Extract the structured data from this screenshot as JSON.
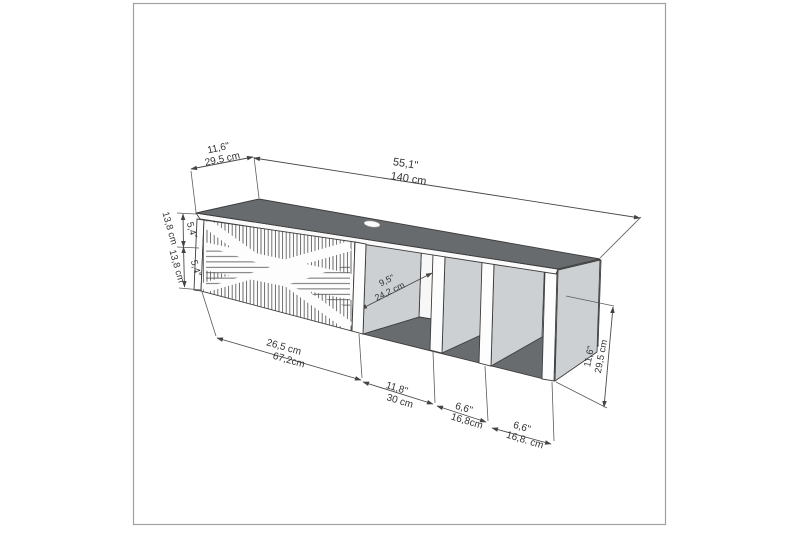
{
  "figure": {
    "kind": "technical dimension drawing",
    "subject": "wall-mounted TV stand with ribbed door and three open shelves"
  },
  "labels": {
    "top_depth_in": "11,6\"",
    "top_depth_cm": "29,5 cm",
    "top_width_in": "55,1\"",
    "top_width_cm": "140 cm",
    "left_upper_in": "5,4\"",
    "left_upper_cm": "13,8 cm",
    "left_lower_in": "5,4\"",
    "left_lower_cm": "13,8 cm",
    "inner_depth_in": "9,5\"",
    "inner_depth_cm": "24,2 cm",
    "bottom_door_a": "26,5 cm",
    "bottom_door_b": "67,2cm",
    "bottom_shelf1_in": "11,8\"",
    "bottom_shelf1_cm": "30 cm",
    "bottom_shelf2_in": "6,6\"",
    "bottom_shelf2_cm": "16,8cm",
    "bottom_shelf3_in": "6,6\"",
    "bottom_shelf3_cm": "16,8. cm",
    "right_height_in": "11,6\"",
    "right_height_cm": "29,5 cm"
  },
  "colors": {
    "top_surface": "#686b6e",
    "interior_floor": "#696c6f",
    "side_panel": "#cdd0d3",
    "outline": "#3d3d3d",
    "dimension": "#4a4a4a",
    "frame_border": "#a0a0a0"
  }
}
